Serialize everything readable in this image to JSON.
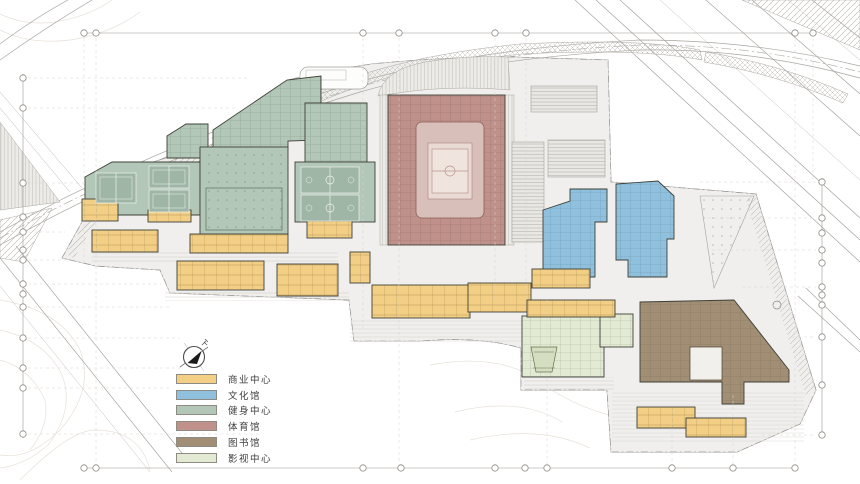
{
  "meta": {
    "drawing_type": "site-master-plan",
    "canvas": {
      "w": 860,
      "h": 484
    }
  },
  "legend": {
    "items": [
      {
        "label": "商业中心",
        "category": "commercial",
        "color": "#F2CF85"
      },
      {
        "label": "文化馆",
        "category": "culture",
        "color": "#8FC0DE"
      },
      {
        "label": "健身中心",
        "category": "fitness",
        "color": "#B2C7B8"
      },
      {
        "label": "体育馆",
        "category": "gym",
        "color": "#C0908A"
      },
      {
        "label": "图书馆",
        "category": "library",
        "color": "#A28E74"
      },
      {
        "label": "影视中心",
        "category": "cinema",
        "color": "#E2EAD3"
      }
    ]
  },
  "palette": {
    "commercial": {
      "fill": "#F2CF85",
      "stroke": "#77591F"
    },
    "culture": {
      "fill": "#8FC0DE",
      "stroke": "#2F5B77"
    },
    "fitness": {
      "fill": "#B2C7B8",
      "stroke": "#4E6154"
    },
    "gym": {
      "fill": "#C0908A",
      "stroke": "#66352D"
    },
    "library": {
      "fill": "#A28E74",
      "stroke": "#4E4130"
    },
    "cinema": {
      "fill": "#E2EAD3",
      "stroke": "#63714F"
    }
  },
  "buildings": [
    {
      "name": "fitness-north-band",
      "category": "fitness",
      "shape": "poly",
      "points": "213,148 213,130 287,80 321,76 321,140 288,141 288,148",
      "overlay": "rooms"
    },
    {
      "name": "fitness-northeast-block",
      "category": "fitness",
      "shape": "poly",
      "points": "305,103 367,103 367,162 305,162",
      "overlay": "rooms"
    },
    {
      "name": "fitness-entry-pavilion",
      "category": "fitness",
      "shape": "poly",
      "points": "167,158 167,136 186,124 208,124 208,158",
      "overlay": "rooms"
    },
    {
      "name": "fitness-tennis-hall",
      "category": "fitness",
      "shape": "poly",
      "points": "85,177 112,162 200,162 200,215 85,215",
      "overlay": ""
    },
    {
      "name": "fitness-main-hall",
      "category": "fitness",
      "shape": "rect",
      "x": 200,
      "y": 147,
      "w": 88,
      "h": 88,
      "overlay": "dots"
    },
    {
      "name": "fitness-basketball-hall",
      "category": "fitness",
      "shape": "rect",
      "x": 295,
      "y": 162,
      "w": 80,
      "h": 60,
      "overlay": ""
    },
    {
      "name": "gymnasium",
      "category": "gym",
      "shape": "rect",
      "x": 388,
      "y": 95,
      "w": 117,
      "h": 150,
      "overlay": "rooms"
    },
    {
      "name": "culture-west-wing",
      "category": "culture",
      "shape": "poly",
      "points": "543,210 570,201 570,189 607,189 607,222 595,222 595,277 543,277",
      "overlay": "rooms"
    },
    {
      "name": "culture-east-wing",
      "category": "culture",
      "shape": "poly",
      "points": "616,184 658,181 674,196 674,239 667,239 667,277 628,277 628,260 616,260",
      "overlay": "rooms"
    },
    {
      "name": "library",
      "category": "library",
      "shape": "poly",
      "points": "640,302 734,300 789,370 789,382 744,382 744,404 722,404 722,382 640,382",
      "overlay": "rooms"
    },
    {
      "name": "cinema-hall",
      "category": "cinema",
      "shape": "rect",
      "x": 522,
      "y": 316,
      "w": 82,
      "h": 61,
      "overlay": "rooms"
    },
    {
      "name": "cinema-annex",
      "category": "cinema",
      "shape": "rect",
      "x": 600,
      "y": 314,
      "w": 33,
      "h": 33,
      "overlay": "rooms"
    },
    {
      "name": "commercial-strip-1",
      "category": "commercial",
      "shape": "rect",
      "x": 82,
      "y": 199,
      "w": 36,
      "h": 22,
      "overlay": "modules"
    },
    {
      "name": "commercial-strip-2",
      "category": "commercial",
      "shape": "rect",
      "x": 148,
      "y": 210,
      "w": 43,
      "h": 12,
      "overlay": "modules"
    },
    {
      "name": "commercial-strip-3",
      "category": "commercial",
      "shape": "rect",
      "x": 92,
      "y": 230,
      "w": 66,
      "h": 22,
      "overlay": "modules"
    },
    {
      "name": "commercial-strip-4",
      "category": "commercial",
      "shape": "rect",
      "x": 190,
      "y": 234,
      "w": 98,
      "h": 19,
      "overlay": "modules"
    },
    {
      "name": "commercial-strip-5",
      "category": "commercial",
      "shape": "rect",
      "x": 177,
      "y": 261,
      "w": 87,
      "h": 29,
      "overlay": "modules"
    },
    {
      "name": "commercial-strip-6",
      "category": "commercial",
      "shape": "rect",
      "x": 277,
      "y": 264,
      "w": 61,
      "h": 32,
      "overlay": "modules"
    },
    {
      "name": "commercial-strip-7",
      "category": "commercial",
      "shape": "rect",
      "x": 307,
      "y": 221,
      "w": 45,
      "h": 17,
      "overlay": "modules"
    },
    {
      "name": "commercial-strip-8",
      "category": "commercial",
      "shape": "rect",
      "x": 350,
      "y": 252,
      "w": 20,
      "h": 31,
      "overlay": "modules"
    },
    {
      "name": "commercial-strip-9",
      "category": "commercial",
      "shape": "rect",
      "x": 372,
      "y": 285,
      "w": 98,
      "h": 33,
      "overlay": "modules"
    },
    {
      "name": "commercial-strip-10",
      "category": "commercial",
      "shape": "rect",
      "x": 468,
      "y": 283,
      "w": 63,
      "h": 29,
      "overlay": "modules"
    },
    {
      "name": "commercial-strip-11",
      "category": "commercial",
      "shape": "rect",
      "x": 532,
      "y": 269,
      "w": 58,
      "h": 19,
      "overlay": "modules"
    },
    {
      "name": "commercial-strip-12",
      "category": "commercial",
      "shape": "rect",
      "x": 527,
      "y": 300,
      "w": 88,
      "h": 17,
      "overlay": "modules"
    },
    {
      "name": "commercial-strip-13",
      "category": "commercial",
      "shape": "rect",
      "x": 637,
      "y": 407,
      "w": 58,
      "h": 21,
      "overlay": "modules"
    },
    {
      "name": "commercial-strip-14",
      "category": "commercial",
      "shape": "rect",
      "x": 686,
      "y": 418,
      "w": 60,
      "h": 19,
      "overlay": "modules"
    }
  ],
  "site_features": [
    {
      "name": "parking-structure-east",
      "pattern": "stripes",
      "shape": "rect",
      "x": 512,
      "y": 142,
      "w": 32,
      "h": 100
    },
    {
      "name": "parking-structure-north",
      "pattern": "stripes",
      "shape": "rect",
      "x": 548,
      "y": 140,
      "w": 57,
      "h": 37
    },
    {
      "name": "service-structure",
      "pattern": "stripes",
      "shape": "rect",
      "x": 531,
      "y": 86,
      "w": 66,
      "h": 26
    },
    {
      "name": "plaza-wedge",
      "pattern": "dots",
      "shape": "poly",
      "points": "700,196 754,196 714,288"
    }
  ],
  "courts": {
    "court_fill": "#9FB5A6",
    "line_color": "#EFF3EE",
    "tennis": [
      {
        "x": 96,
        "y": 173,
        "w": 40,
        "h": 30
      },
      {
        "x": 149,
        "y": 166,
        "w": 40,
        "h": 22
      },
      {
        "x": 149,
        "y": 190,
        "w": 40,
        "h": 22
      }
    ],
    "basketball": [
      {
        "x": 301,
        "y": 167,
        "w": 58,
        "h": 26
      },
      {
        "x": 301,
        "y": 195,
        "w": 58,
        "h": 26
      }
    ]
  },
  "arena": {
    "outer": {
      "x": 416,
      "y": 122,
      "w": 68,
      "h": 96
    },
    "mid": {
      "x": 428,
      "y": 143,
      "w": 44,
      "h": 56
    },
    "court": {
      "x": 432,
      "y": 149,
      "w": 36,
      "h": 44
    },
    "outer_fill": "#D9BFB9",
    "mid_fill": "#E9DAD5",
    "court_fill": "#F0E4DF",
    "line_color": "#BA958D"
  },
  "grid_markers": {
    "top": {
      "y": 33,
      "line": [
        84,
        813
      ],
      "markers": [
        84,
        96,
        363,
        399,
        495,
        526,
        795,
        813
      ]
    },
    "bottom": {
      "y": 468,
      "line": [
        84,
        798
      ],
      "markers": [
        84,
        96,
        363,
        401,
        495,
        525,
        547,
        672,
        733,
        795
      ]
    },
    "left": {
      "x": 23,
      "line": [
        74,
        438
      ],
      "markers": [
        78,
        108,
        183,
        217,
        232,
        250,
        260,
        284,
        294,
        307,
        338,
        368,
        388,
        434
      ]
    },
    "right": {
      "x": 822,
      "line": [
        178,
        438
      ],
      "markers": [
        182,
        218,
        233,
        250,
        263,
        287,
        295,
        305,
        337,
        385,
        435
      ]
    }
  }
}
